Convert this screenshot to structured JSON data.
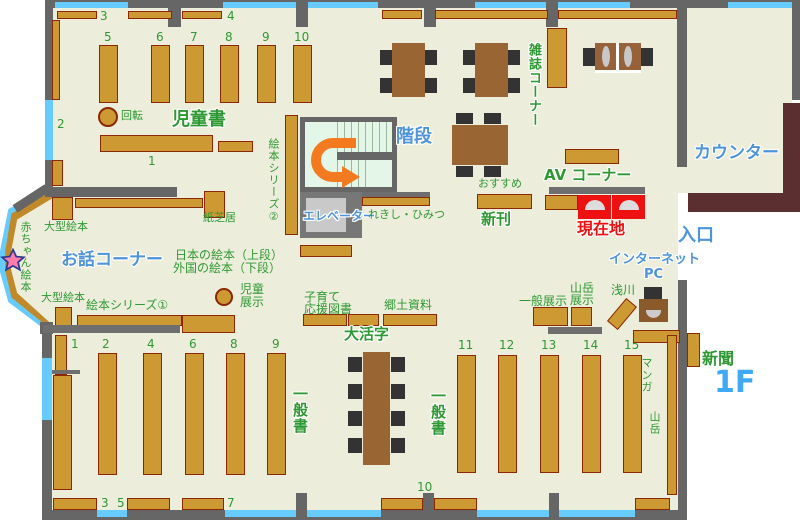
{
  "floor_label": "1F",
  "labels": {
    "jidosho": "児童書",
    "kaiten": "回転",
    "ohanashi": "お話コーナー",
    "akachan": "赤ちゃん絵本",
    "ogata1": "大型絵本",
    "ogata2": "大型絵本",
    "kamishibai": "紙芝居",
    "series1": "絵本シリーズ①",
    "series2": "絵本シリーズ②",
    "nihon": "日本の絵本（上段）",
    "gaikoku": "外国の絵本（下段）",
    "jido": "児童",
    "tenji": "展示",
    "kaidan": "階段",
    "elevator": "エレベーター",
    "rekishi": "れきし・ひみつ",
    "zasshi": "雑誌コーナー",
    "counter": "カウンター",
    "osusume": "おすすめ",
    "shinkan": "新刊",
    "av": "AV コーナー",
    "genzaichi": "現在地",
    "iriguchi": "入口",
    "internet": "インターネット",
    "pc": "PC",
    "asakawa": "浅川",
    "ippan_tenji": "一般展示",
    "sangaku_tenji1": "山岳",
    "sangaku_tenji2": "展示",
    "kosodate1": "子育て",
    "kosodate2": "応援図書",
    "kyodo": "郷土資料",
    "daikatsuji": "大活字",
    "ippansho1": "一般書",
    "ippansho2": "一般書",
    "manga": "マンガ",
    "sangaku": "山岳",
    "shinbun": "新聞"
  },
  "numbers": {
    "t3": "3",
    "t4": "4",
    "c5": "5",
    "c6": "6",
    "c7": "7",
    "c8": "8",
    "c9": "9",
    "c10": "10",
    "c1": "1",
    "c2": "2",
    "a1": "1",
    "a2": "2",
    "a4": "4",
    "a6": "6",
    "a8": "8",
    "a9": "9",
    "a11": "11",
    "a12": "12",
    "a13": "13",
    "a14": "14",
    "a15": "15",
    "b3": "3",
    "b5": "5",
    "b7": "7",
    "b10": "10"
  },
  "colors": {
    "floor": "#ededdb",
    "wall": "#666666",
    "window": "#66ccff",
    "shelf": "#cc9933",
    "shelf_border": "#8b2703",
    "table": "#996633",
    "counter": "#5b2f2f",
    "green_text": "#2e9933",
    "blue_text": "#4d94db",
    "red_marker": "#ee1111",
    "arrow_orange": "#f47a20",
    "stairs_fill": "#e3f6e7",
    "elevator_fill": "#c9c9c9"
  }
}
